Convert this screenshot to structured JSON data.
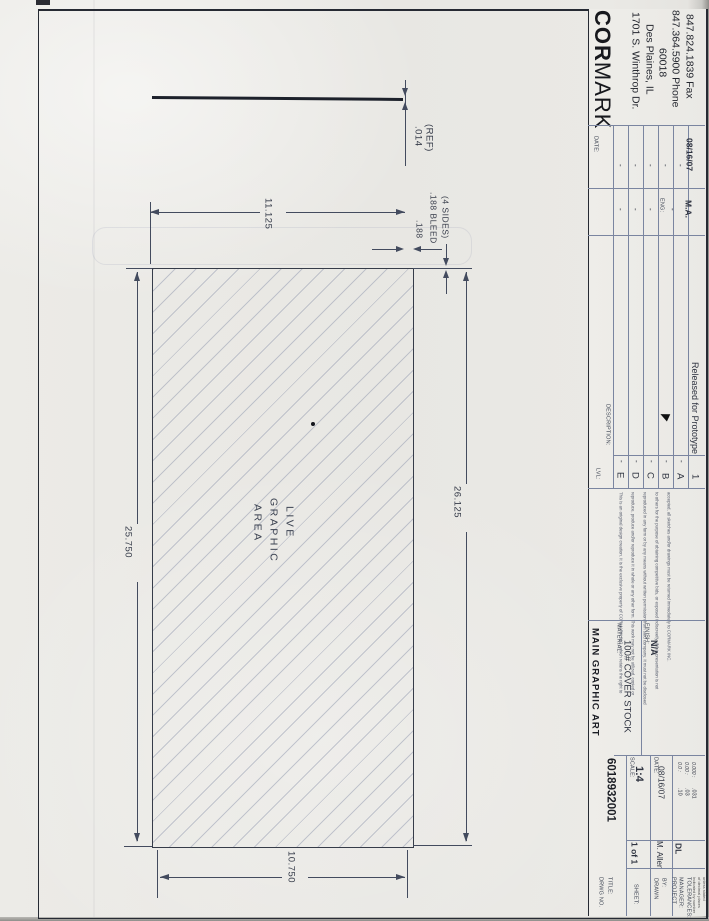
{
  "company": {
    "name_bold": "COR",
    "name_light": "MARK",
    "address1": "1701 S. Winthrop Dr.",
    "address2": "Des Plaines, IL",
    "address3": "60018",
    "phone": "847.364.5900 Phone",
    "fax": "847.824.1839 Fax"
  },
  "revisions": {
    "lvl_header": "LVL:",
    "desc_header": "DESCRIPTION:",
    "eng_header": "ENG:",
    "date_header": "DATE:",
    "dash": "-",
    "lvl_e": "E",
    "lvl_d": "D",
    "lvl_c": "C",
    "lvl_b": "B",
    "lvl_a": "A",
    "lvl_1": "1",
    "released_desc": "Released for Prototype",
    "released_eng": "M.A.",
    "released_date": "08/16/07"
  },
  "disclaimer": {
    "l1": "This is an original design creation. It is the exclusive property of CORMARK INC. which retains the right to",
    "l2": "reproduce, produce and/or reproduce it in whole or any other form. This work may not be utilized, copied or",
    "l3": "reproduced in any form or by any means without written permission from said company. It must not be disclosed",
    "l4": "to others for the purpose of obtaining competitive bids, or exposed indiscreetly. If this presentation is not",
    "l5": "accepted, all sketches and/or drawings must be returned immediately to CORMARK INC."
  },
  "title_block": {
    "drwg_no_label": "DRWG NO.",
    "title_label": "TITLE:",
    "drwg_no": "6018932001",
    "title": "MAIN GRAPHIC ART",
    "sheet_label": "SHEET:",
    "sheet": "1 of 1",
    "scale_label": "SCALE:",
    "scale": "1:4",
    "material_label": "MATERIAL:",
    "material": "100# COVER STOCK",
    "date_label": "DATE:",
    "date": "08/16/07",
    "finish_label": "FINISH:",
    "finish": "N/A",
    "drawn_by_label1": "DRAWN",
    "drawn_by_label2": "BY:",
    "drawn_by": "M. Allen",
    "pm_label1": "PROJECT",
    "pm_label2": "MANAGER:",
    "pm": "DL",
    "tol_label": "TOLERANCES:",
    "tol_note1": "Indicated by number",
    "tol_note2": "of decimal places",
    "tol_note3": "unless stated",
    "tol_l1": "0.0 :",
    "tol_v1": ".10",
    "tol_l2": "0.00 :",
    "tol_v2": ".03",
    "tol_l3": "0.000 :",
    "tol_v3": ".031"
  },
  "drawing": {
    "ref_dim": ".014",
    "ref_suffix": "(REF)",
    "bleed_width": "11.125",
    "bleed_dim": ".188",
    "bleed_note1": ".188 BLEED",
    "bleed_note2": "(4 SIDES)",
    "overall_length": "26.125",
    "live_length": "25.750",
    "live_width": "10.750",
    "area_l1": "LIVE",
    "area_l2": "GRAPHIC",
    "area_l3": "AREA"
  }
}
